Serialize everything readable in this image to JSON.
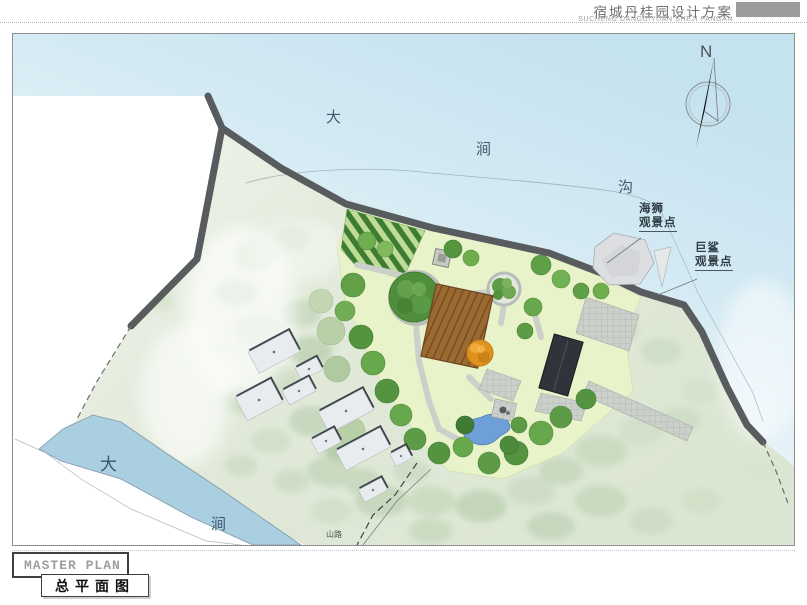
{
  "header": {
    "title": "宿城丹桂园设计方案",
    "subtitle": "SUCHENG DANGUIYUAN SHEJI FANGAN"
  },
  "compass": {
    "label": "N"
  },
  "map": {
    "sea_chars": [
      "大",
      "涧",
      "沟"
    ],
    "lake_chars": [
      "大",
      "涧"
    ],
    "viewpoints": [
      {
        "name": "海狮",
        "suffix": "观景点"
      },
      {
        "name": "巨鲨",
        "suffix": "观景点"
      }
    ],
    "trail_label": "山路"
  },
  "footer": {
    "title_en": "MASTER PLAN",
    "title_cn": "总平面图"
  },
  "colors": {
    "header_block": "#9b9b9b",
    "sea": "#c5e2ef",
    "lake": "#a9cfe0",
    "road_wall": "#595c5f",
    "lawn": "#e9f3c9",
    "deck_wood": "#9b6a33",
    "dark_roof": "#2f343a",
    "pond": "#6f9fd9",
    "orange_tree": "#e0921e",
    "rock": "#dcdee0"
  }
}
